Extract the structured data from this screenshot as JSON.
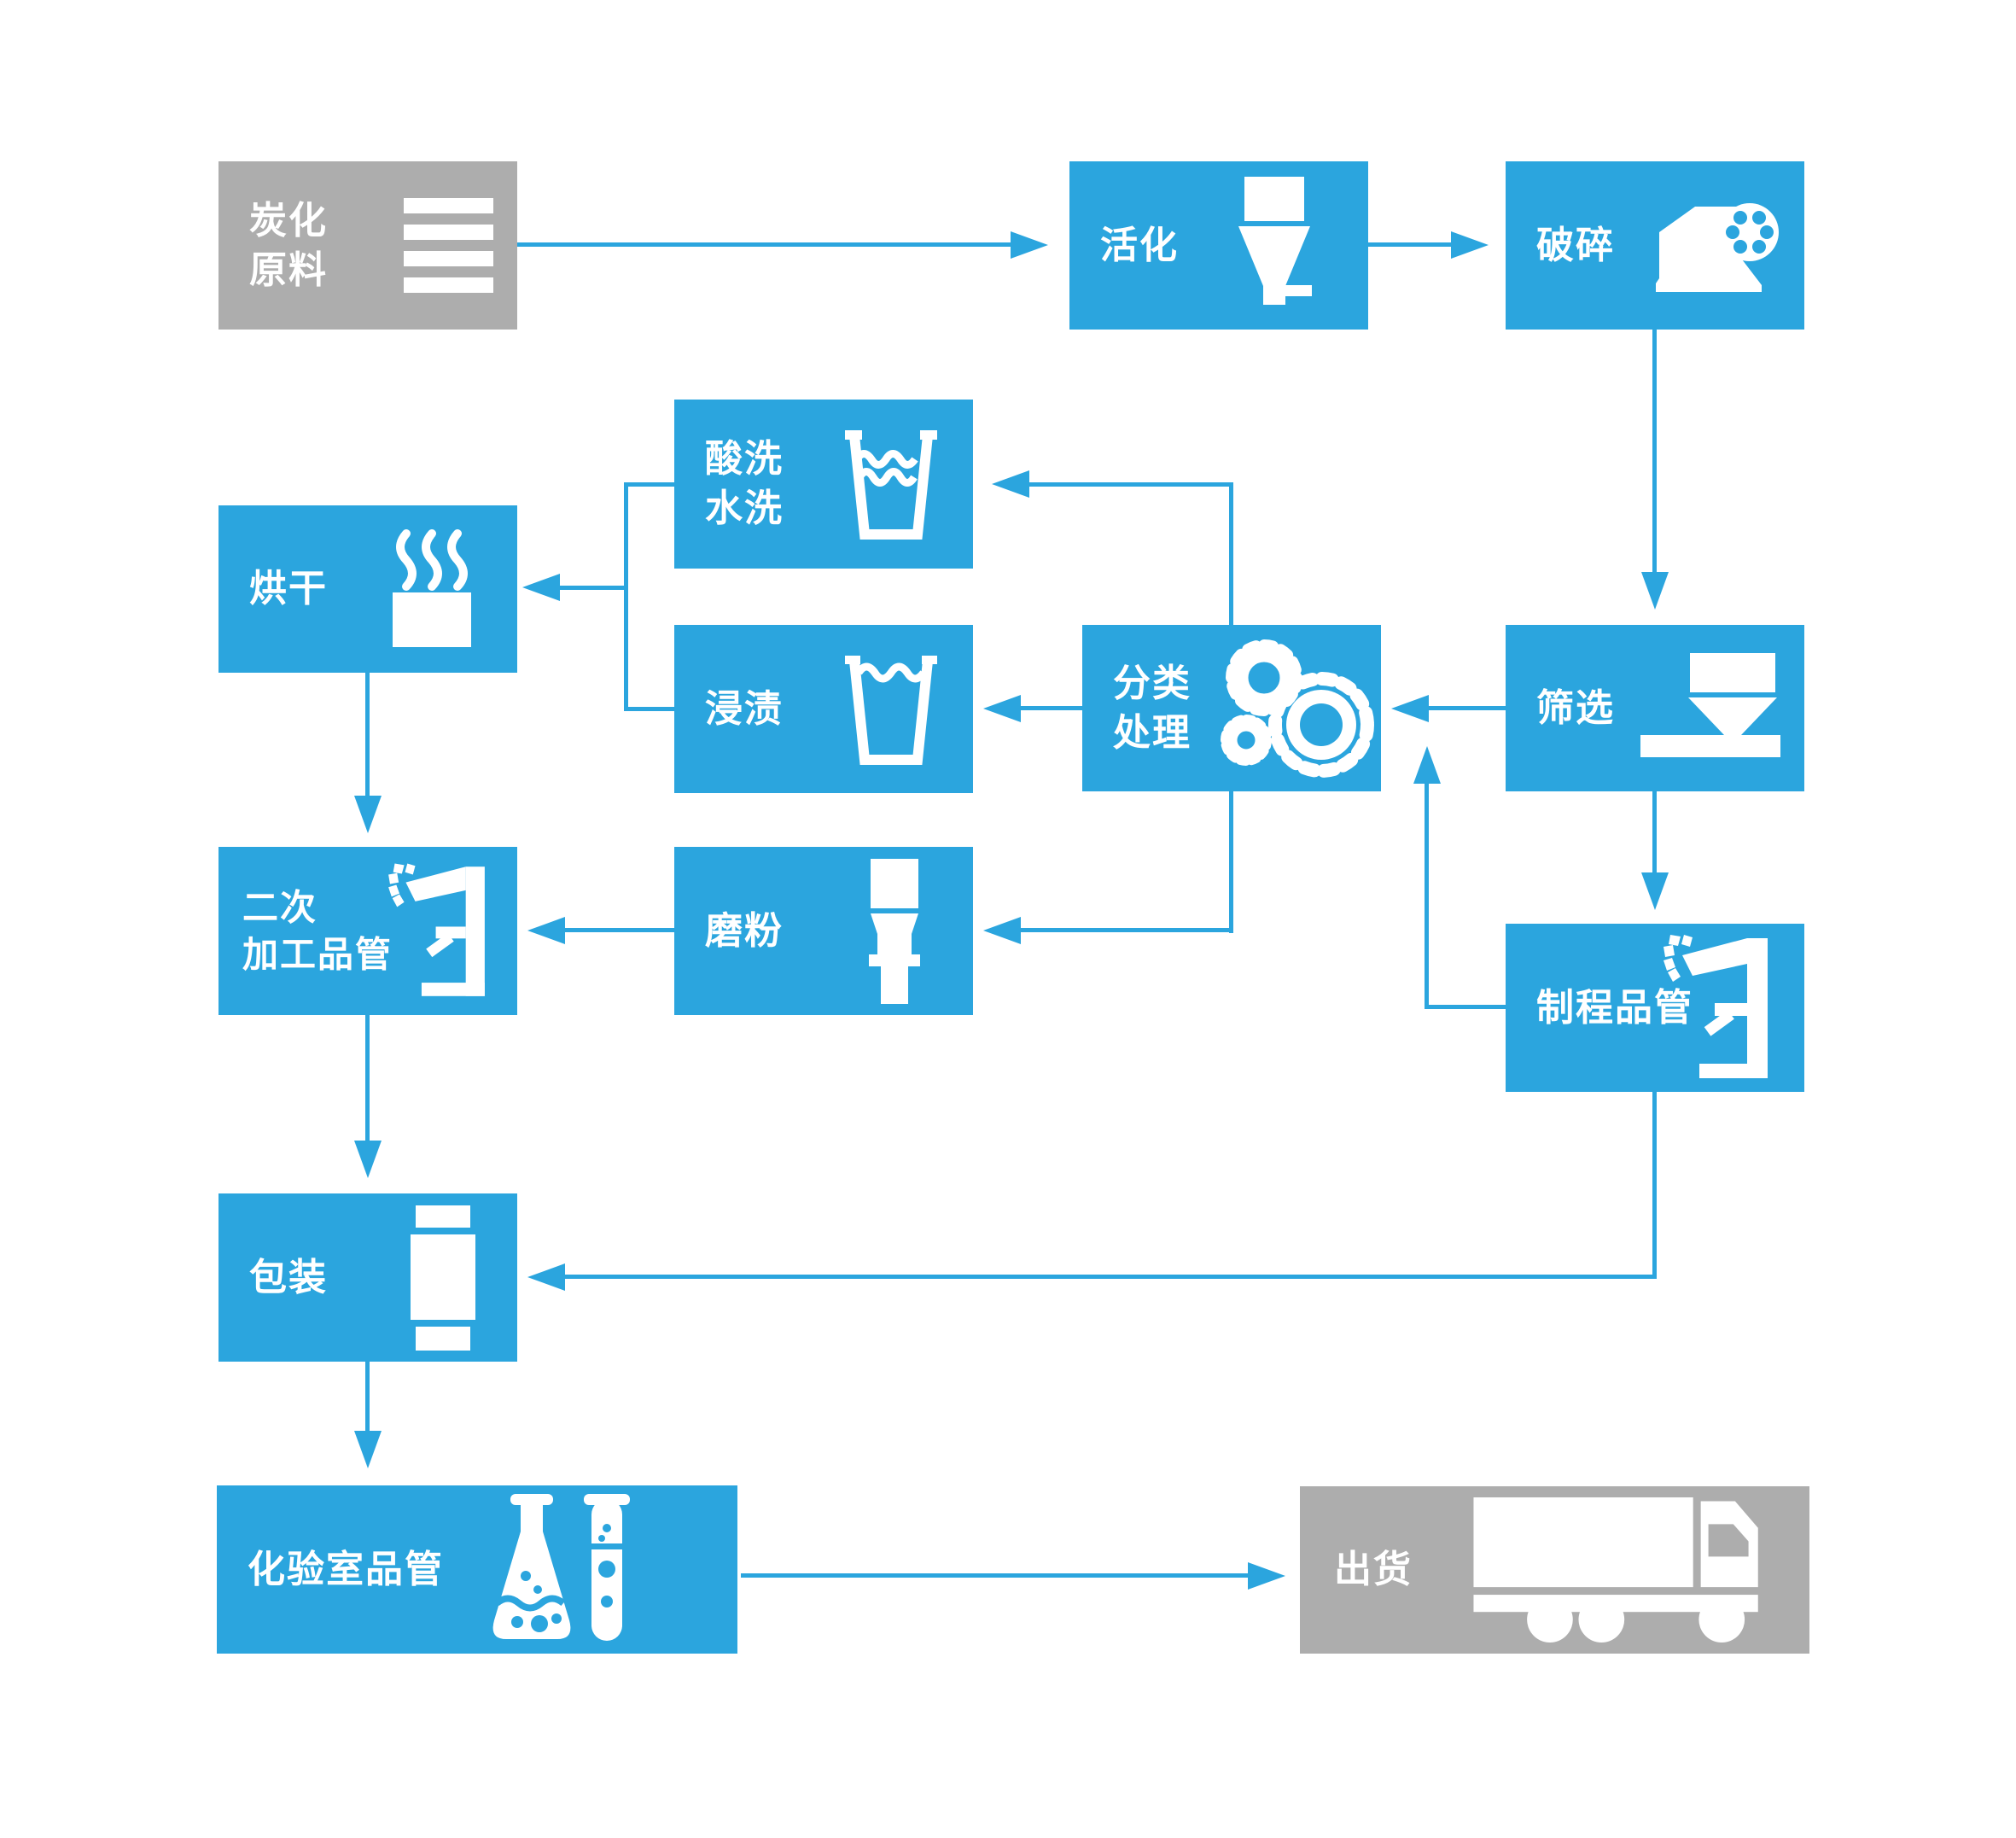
{
  "diagram": {
    "type": "flowchart",
    "background": "#ffffff",
    "colors": {
      "node_blue": "#2BA5DE",
      "node_gray": "#ADADAD",
      "arrow": "#2BA5DE",
      "label_text": "#ffffff"
    },
    "nodes": [
      {
        "id": "carbonized-raw-material",
        "label": "炭化\n原料",
        "icon": "list-icon",
        "variant": "gray"
      },
      {
        "id": "activation",
        "label": "活化",
        "icon": "funnel-icon",
        "variant": "blue"
      },
      {
        "id": "crushing",
        "label": "破碎",
        "icon": "crusher-icon",
        "variant": "blue"
      },
      {
        "id": "acid-wash-water-wash",
        "label": "酸洗\n水洗",
        "icon": "washing-cup-icon",
        "variant": "blue"
      },
      {
        "id": "drying",
        "label": "烘干",
        "icon": "steam-cup-icon",
        "variant": "blue"
      },
      {
        "id": "impregnation",
        "label": "浸渍",
        "icon": "soaking-cup-icon",
        "variant": "blue"
      },
      {
        "id": "sorting-treatment",
        "label": "分类\n处理",
        "icon": "gears-icon",
        "variant": "blue"
      },
      {
        "id": "screening",
        "label": "筛选",
        "icon": "hopper-icon",
        "variant": "blue"
      },
      {
        "id": "secondary-processing-qc",
        "label": "二次\n加工品管",
        "icon": "microscope-icon",
        "variant": "blue"
      },
      {
        "id": "grinding",
        "label": "磨粉",
        "icon": "mill-icon",
        "variant": "blue"
      },
      {
        "id": "process-qc",
        "label": "制程品管",
        "icon": "microscope-icon",
        "variant": "blue"
      },
      {
        "id": "packaging",
        "label": "包装",
        "icon": "package-icon",
        "variant": "blue"
      },
      {
        "id": "laboratory-qc",
        "label": "化验室品管",
        "icon": "lab-glassware-icon",
        "variant": "blue"
      },
      {
        "id": "shipping",
        "label": "出货",
        "icon": "truck-icon",
        "variant": "gray"
      }
    ],
    "edges": [
      {
        "from": "carbonized-raw-material",
        "to": "activation"
      },
      {
        "from": "activation",
        "to": "crushing"
      },
      {
        "from": "crushing",
        "to": "screening"
      },
      {
        "from": "screening",
        "to": "sorting-treatment"
      },
      {
        "from": "sorting-treatment",
        "to": "acid-wash-water-wash"
      },
      {
        "from": "sorting-treatment",
        "to": "impregnation"
      },
      {
        "from": "acid-wash-water-wash",
        "to": "drying"
      },
      {
        "from": "impregnation",
        "to": "drying"
      },
      {
        "from": "drying",
        "to": "secondary-processing-qc"
      },
      {
        "from": "sorting-treatment",
        "to": "grinding"
      },
      {
        "from": "grinding",
        "to": "secondary-processing-qc"
      },
      {
        "from": "screening",
        "to": "process-qc"
      },
      {
        "from": "process-qc",
        "to": "sorting-treatment"
      },
      {
        "from": "process-qc",
        "to": "packaging"
      },
      {
        "from": "secondary-processing-qc",
        "to": "packaging"
      },
      {
        "from": "packaging",
        "to": "laboratory-qc"
      },
      {
        "from": "laboratory-qc",
        "to": "shipping"
      }
    ]
  }
}
